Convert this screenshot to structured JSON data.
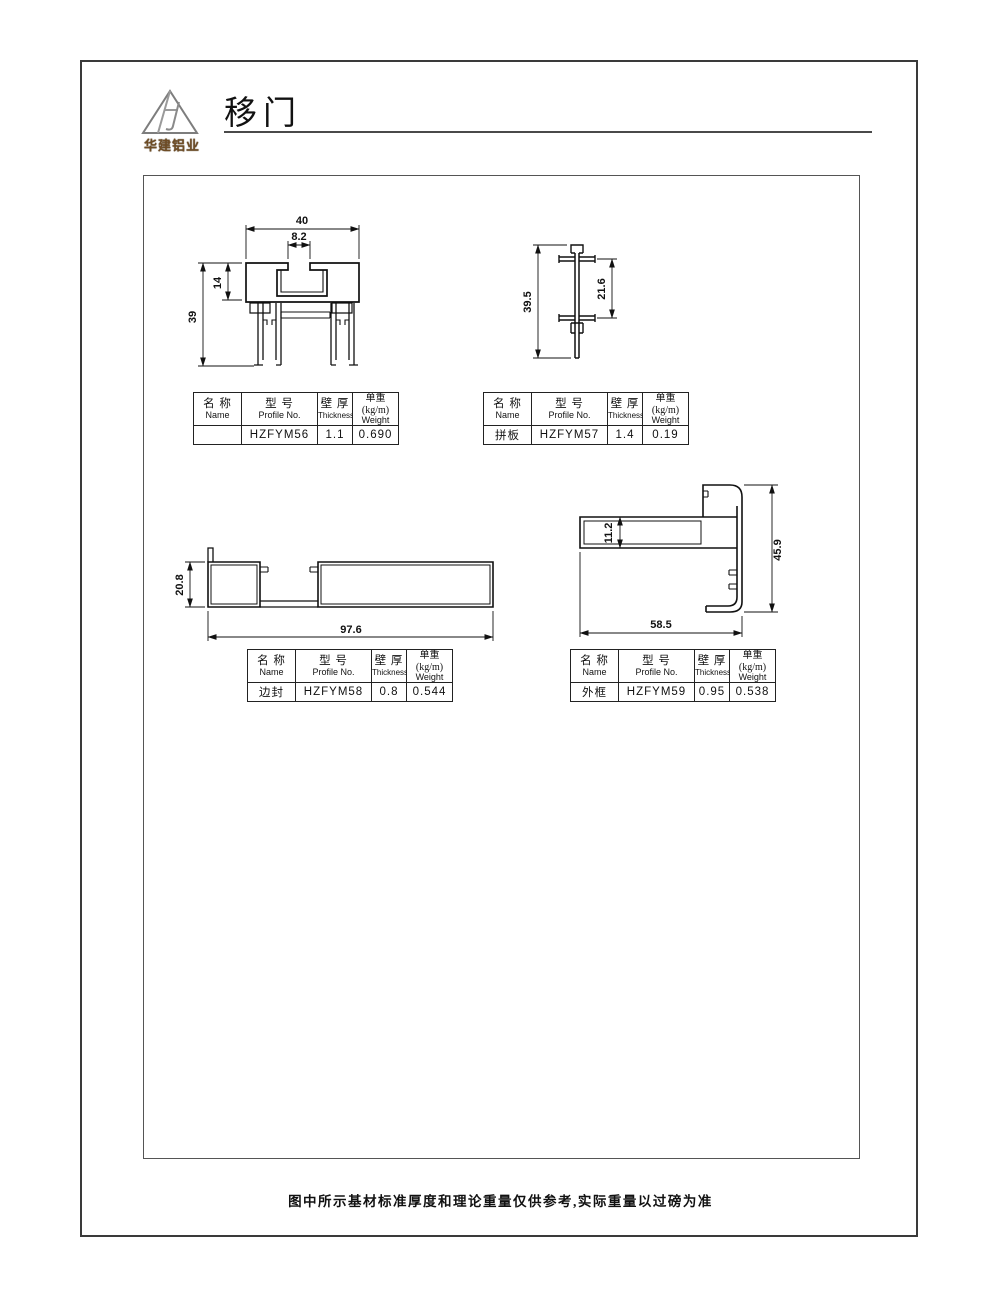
{
  "page": {
    "title": "移门",
    "logo_text": "华建铝业",
    "footer_note": "图中所示基材标准厚度和理论重量仅供参考,实际重量以过磅为准"
  },
  "table_headers": {
    "name_cn": "名 称",
    "name_en": "Name",
    "profile_cn": "型 号",
    "profile_en": "Profile No.",
    "thickness_cn": "壁 厚",
    "thickness_en": "Thickness",
    "weight_cn": "单重(kg/m)",
    "weight_en": "Weight"
  },
  "profiles": [
    {
      "name": "",
      "profile_no": "HZFYM56",
      "thickness": "1.1",
      "weight": "0.690",
      "dims": {
        "width": "40",
        "slot": "8.2",
        "upper": "14",
        "height": "39"
      }
    },
    {
      "name": "拼板",
      "profile_no": "HZFYM57",
      "thickness": "1.4",
      "weight": "0.19",
      "dims": {
        "height": "39.5",
        "mid": "21.6"
      }
    },
    {
      "name": "边封",
      "profile_no": "HZFYM58",
      "thickness": "0.8",
      "weight": "0.544",
      "dims": {
        "height": "20.8",
        "width": "97.6"
      }
    },
    {
      "name": "外框",
      "profile_no": "HZFYM59",
      "thickness": "0.95",
      "weight": "0.538",
      "dims": {
        "inner": "11.2",
        "height": "45.9",
        "width": "58.5"
      }
    }
  ]
}
